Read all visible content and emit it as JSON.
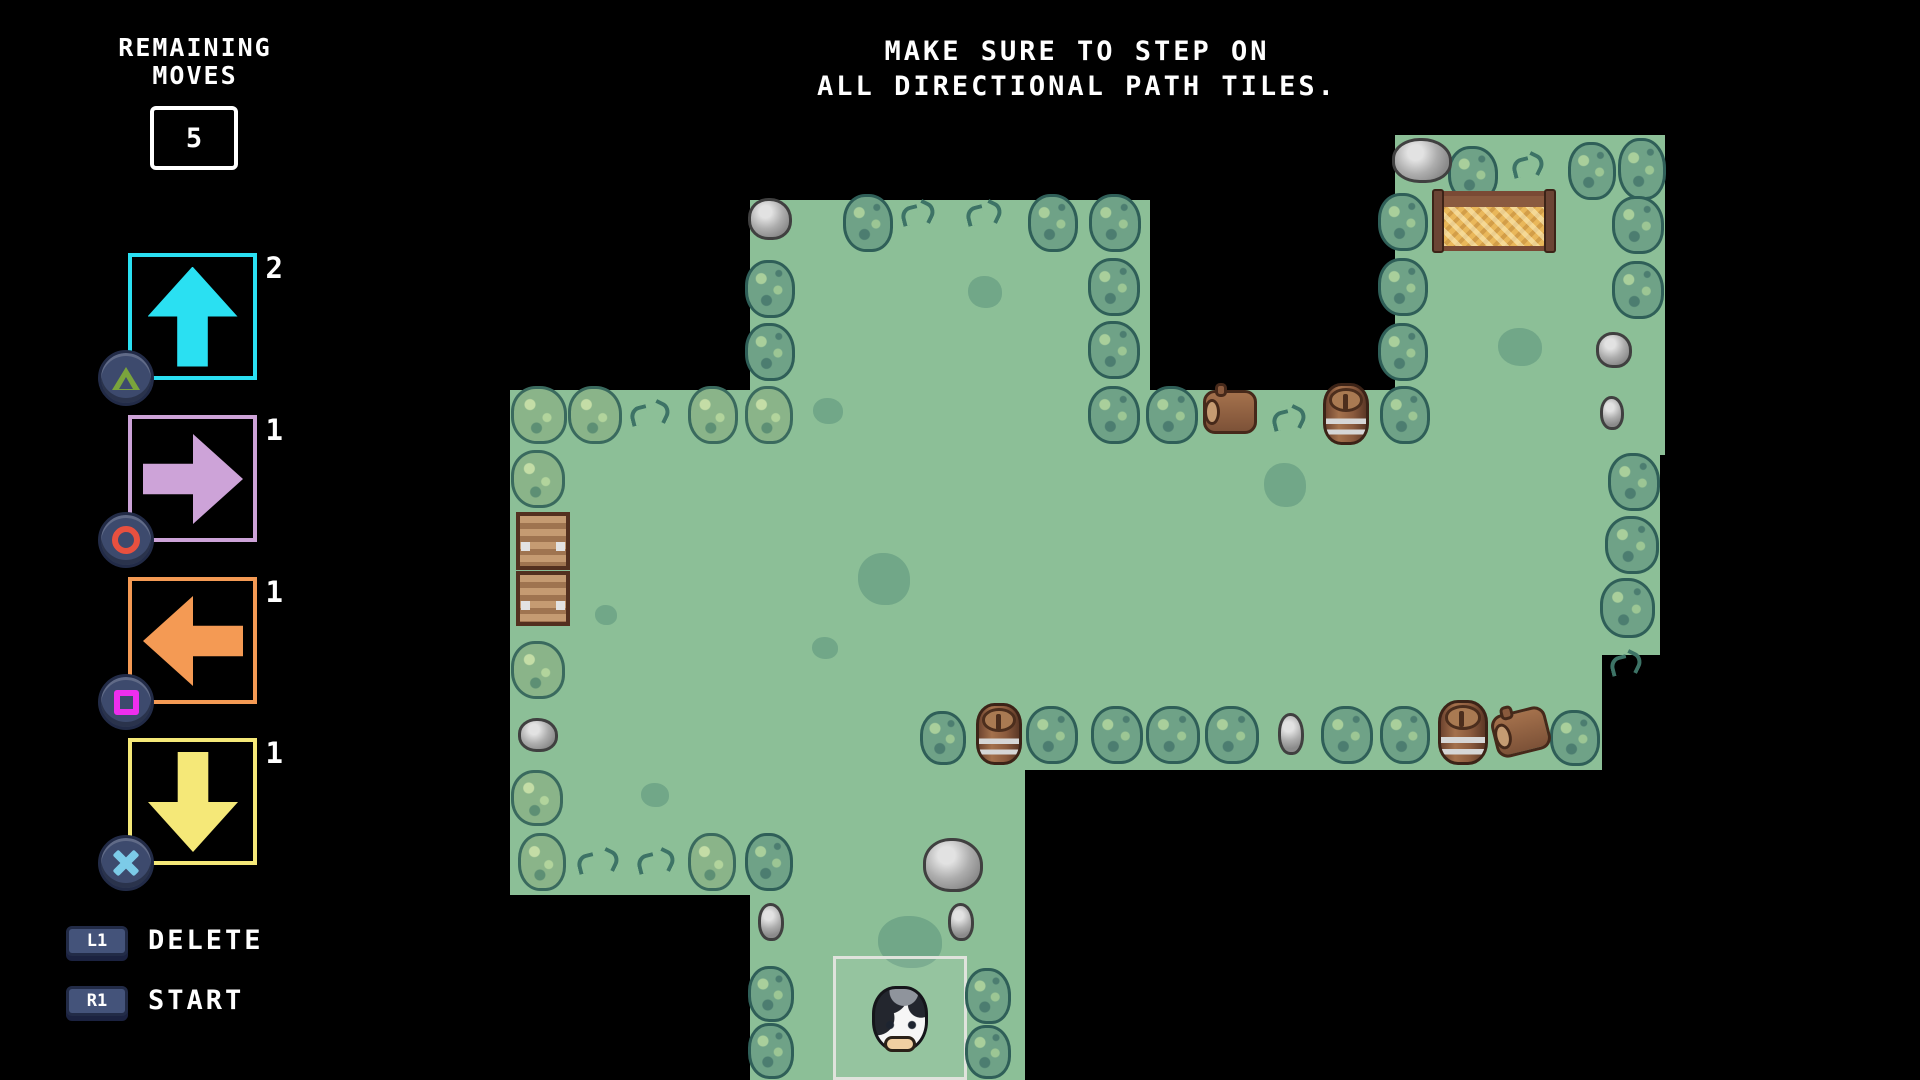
{
  "colors": {
    "background": "#000000",
    "grass": "#8cbf97",
    "cyan": "#2ae0f2",
    "purple": "#cda3d8",
    "orange": "#f49a54",
    "yellow": "#f5e878",
    "ps_triangle": "#7aa43c",
    "ps_circle": "#e8503f",
    "ps_square": "#ee2eee",
    "ps_cross": "#7ccbe8"
  },
  "hud": {
    "remaining_title_line1": "REMAINING",
    "remaining_title_line2": "MOVES",
    "remaining_moves_value": "5",
    "instruction_line1": "MAKE SURE TO STEP ON",
    "instruction_line2": "ALL DIRECTIONAL PATH TILES.",
    "move_buttons": [
      {
        "direction": "up",
        "count": "2",
        "color": "#2ae0f2",
        "ps_button": "triangle"
      },
      {
        "direction": "right",
        "count": "1",
        "color": "#cda3d8",
        "ps_button": "circle"
      },
      {
        "direction": "left",
        "count": "1",
        "color": "#f49a54",
        "ps_button": "square"
      },
      {
        "direction": "down",
        "count": "1",
        "color": "#f5e878",
        "ps_button": "cross"
      }
    ],
    "actions": [
      {
        "key": "L1",
        "label": "DELETE"
      },
      {
        "key": "R1",
        "label": "START"
      }
    ]
  },
  "map": {
    "grass_regions": [
      {
        "x": 750,
        "y": 200,
        "w": 400,
        "h": 250
      },
      {
        "x": 1395,
        "y": 135,
        "w": 270,
        "h": 320
      },
      {
        "x": 510,
        "y": 390,
        "w": 1150,
        "h": 265
      },
      {
        "x": 510,
        "y": 650,
        "w": 1092,
        "h": 120
      },
      {
        "x": 510,
        "y": 700,
        "w": 292,
        "h": 195
      },
      {
        "x": 750,
        "y": 768,
        "w": 275,
        "h": 312
      }
    ],
    "objects": [
      {
        "type": "decal",
        "x": 813,
        "y": 398,
        "w": 30,
        "h": 26
      },
      {
        "type": "decal",
        "x": 968,
        "y": 276,
        "w": 34,
        "h": 32
      },
      {
        "type": "decal",
        "x": 858,
        "y": 553,
        "w": 52,
        "h": 52
      },
      {
        "type": "decal",
        "x": 1264,
        "y": 463,
        "w": 42,
        "h": 44
      },
      {
        "type": "decal",
        "x": 1498,
        "y": 328,
        "w": 44,
        "h": 38
      },
      {
        "type": "decal",
        "x": 641,
        "y": 783,
        "w": 28,
        "h": 24
      },
      {
        "type": "decal",
        "x": 878,
        "y": 916,
        "w": 64,
        "h": 52
      },
      {
        "type": "decal",
        "x": 595,
        "y": 605,
        "w": 22,
        "h": 20
      },
      {
        "type": "decal",
        "x": 812,
        "y": 637,
        "w": 26,
        "h": 22
      },
      {
        "type": "start-tile",
        "x": 833,
        "y": 956,
        "w": 134,
        "h": 124
      },
      {
        "type": "bush",
        "x": 843,
        "y": 194,
        "w": 50,
        "h": 58
      },
      {
        "type": "bush",
        "x": 1028,
        "y": 194,
        "w": 50,
        "h": 58
      },
      {
        "type": "bush",
        "x": 1089,
        "y": 194,
        "w": 52,
        "h": 58
      },
      {
        "type": "bush",
        "x": 745,
        "y": 260,
        "w": 50,
        "h": 58
      },
      {
        "type": "bush",
        "x": 745,
        "y": 323,
        "w": 50,
        "h": 58
      },
      {
        "type": "bush",
        "x": 1088,
        "y": 258,
        "w": 52,
        "h": 58
      },
      {
        "type": "bush",
        "x": 1088,
        "y": 321,
        "w": 52,
        "h": 58
      },
      {
        "type": "bush",
        "x": 1088,
        "y": 386,
        "w": 52,
        "h": 58
      },
      {
        "type": "bush",
        "x": 1146,
        "y": 386,
        "w": 52,
        "h": 58
      },
      {
        "type": "bush",
        "x": 1380,
        "y": 386,
        "w": 50,
        "h": 58
      },
      {
        "type": "bush",
        "x": 1448,
        "y": 146,
        "w": 50,
        "h": 56
      },
      {
        "type": "bush",
        "x": 1568,
        "y": 142,
        "w": 48,
        "h": 58
      },
      {
        "type": "bush",
        "x": 1618,
        "y": 138,
        "w": 48,
        "h": 62
      },
      {
        "type": "bush",
        "x": 1378,
        "y": 193,
        "w": 50,
        "h": 58
      },
      {
        "type": "bush",
        "x": 1378,
        "y": 258,
        "w": 50,
        "h": 58
      },
      {
        "type": "bush",
        "x": 1378,
        "y": 323,
        "w": 50,
        "h": 58
      },
      {
        "type": "bush",
        "x": 1612,
        "y": 196,
        "w": 52,
        "h": 58
      },
      {
        "type": "bush",
        "x": 1612,
        "y": 261,
        "w": 52,
        "h": 58
      },
      {
        "type": "bush",
        "x": 1608,
        "y": 453,
        "w": 52,
        "h": 58
      },
      {
        "type": "bush",
        "x": 1605,
        "y": 516,
        "w": 54,
        "h": 58
      },
      {
        "type": "bush",
        "x": 1600,
        "y": 578,
        "w": 55,
        "h": 60
      },
      {
        "type": "bush",
        "x": 1550,
        "y": 710,
        "w": 50,
        "h": 56
      },
      {
        "type": "bush",
        "x": 920,
        "y": 711,
        "w": 46,
        "h": 54
      },
      {
        "type": "bush",
        "x": 1026,
        "y": 706,
        "w": 52,
        "h": 58
      },
      {
        "type": "bush",
        "x": 1091,
        "y": 706,
        "w": 52,
        "h": 58
      },
      {
        "type": "bush",
        "x": 1146,
        "y": 706,
        "w": 54,
        "h": 58
      },
      {
        "type": "bush",
        "x": 1205,
        "y": 706,
        "w": 54,
        "h": 58
      },
      {
        "type": "bush",
        "x": 1321,
        "y": 706,
        "w": 52,
        "h": 58
      },
      {
        "type": "bush",
        "x": 1380,
        "y": 706,
        "w": 50,
        "h": 58
      },
      {
        "type": "bush",
        "x": 745,
        "y": 833,
        "w": 48,
        "h": 58
      },
      {
        "type": "bush",
        "x": 748,
        "y": 966,
        "w": 46,
        "h": 56
      },
      {
        "type": "bush",
        "x": 748,
        "y": 1023,
        "w": 46,
        "h": 56
      },
      {
        "type": "bush",
        "x": 965,
        "y": 968,
        "w": 46,
        "h": 56
      },
      {
        "type": "bush",
        "x": 965,
        "y": 1025,
        "w": 46,
        "h": 54
      },
      {
        "type": "bush-light",
        "x": 511,
        "y": 386,
        "w": 56,
        "h": 58
      },
      {
        "type": "bush-light",
        "x": 568,
        "y": 386,
        "w": 54,
        "h": 58
      },
      {
        "type": "bush-light",
        "x": 688,
        "y": 386,
        "w": 50,
        "h": 58
      },
      {
        "type": "bush-light",
        "x": 745,
        "y": 386,
        "w": 48,
        "h": 58
      },
      {
        "type": "bush-light",
        "x": 511,
        "y": 450,
        "w": 54,
        "h": 58
      },
      {
        "type": "bush-light",
        "x": 511,
        "y": 641,
        "w": 54,
        "h": 58
      },
      {
        "type": "bush-light",
        "x": 511,
        "y": 770,
        "w": 52,
        "h": 56
      },
      {
        "type": "bush-light",
        "x": 518,
        "y": 833,
        "w": 48,
        "h": 58
      },
      {
        "type": "bush-light",
        "x": 688,
        "y": 833,
        "w": 48,
        "h": 58
      },
      {
        "type": "tuft",
        "x": 899,
        "y": 198,
        "w": 38,
        "h": 34
      },
      {
        "type": "tuft",
        "x": 964,
        "y": 198,
        "w": 40,
        "h": 36
      },
      {
        "type": "tuft",
        "x": 1510,
        "y": 150,
        "w": 36,
        "h": 34
      },
      {
        "type": "tuft",
        "x": 628,
        "y": 398,
        "w": 44,
        "h": 36
      },
      {
        "type": "tuft",
        "x": 1270,
        "y": 403,
        "w": 38,
        "h": 34
      },
      {
        "type": "tuft",
        "x": 575,
        "y": 846,
        "w": 46,
        "h": 38
      },
      {
        "type": "tuft",
        "x": 635,
        "y": 846,
        "w": 42,
        "h": 38
      },
      {
        "type": "tuft",
        "x": 1608,
        "y": 648,
        "w": 36,
        "h": 36
      },
      {
        "type": "rock",
        "x": 748,
        "y": 198,
        "w": 44,
        "h": 42
      },
      {
        "type": "rock",
        "x": 1392,
        "y": 138,
        "w": 60,
        "h": 45
      },
      {
        "type": "rock",
        "x": 1596,
        "y": 332,
        "w": 36,
        "h": 36
      },
      {
        "type": "rock",
        "x": 1600,
        "y": 396,
        "w": 24,
        "h": 34
      },
      {
        "type": "rock",
        "x": 518,
        "y": 718,
        "w": 40,
        "h": 34
      },
      {
        "type": "rock",
        "x": 923,
        "y": 838,
        "w": 60,
        "h": 54
      },
      {
        "type": "rock",
        "x": 758,
        "y": 903,
        "w": 26,
        "h": 38
      },
      {
        "type": "rock",
        "x": 948,
        "y": 903,
        "w": 26,
        "h": 38
      },
      {
        "type": "rock",
        "x": 1278,
        "y": 713,
        "w": 26,
        "h": 42
      },
      {
        "type": "crate",
        "x": 516,
        "y": 512,
        "w": 54,
        "h": 58
      },
      {
        "type": "crate",
        "x": 516,
        "y": 571,
        "w": 54,
        "h": 55
      },
      {
        "type": "barrel",
        "x": 1323,
        "y": 383,
        "w": 46,
        "h": 62
      },
      {
        "type": "barrel",
        "x": 976,
        "y": 703,
        "w": 46,
        "h": 62
      },
      {
        "type": "barrel",
        "x": 1438,
        "y": 700,
        "w": 50,
        "h": 65
      },
      {
        "type": "log",
        "x": 1203,
        "y": 390,
        "w": 54,
        "h": 44
      },
      {
        "type": "log-tilt",
        "x": 1493,
        "y": 710,
        "w": 56,
        "h": 44
      },
      {
        "type": "hay",
        "x": 1435,
        "y": 191,
        "w": 118,
        "h": 60
      },
      {
        "type": "cow",
        "x": 872,
        "y": 986,
        "w": 56,
        "h": 66
      }
    ]
  }
}
